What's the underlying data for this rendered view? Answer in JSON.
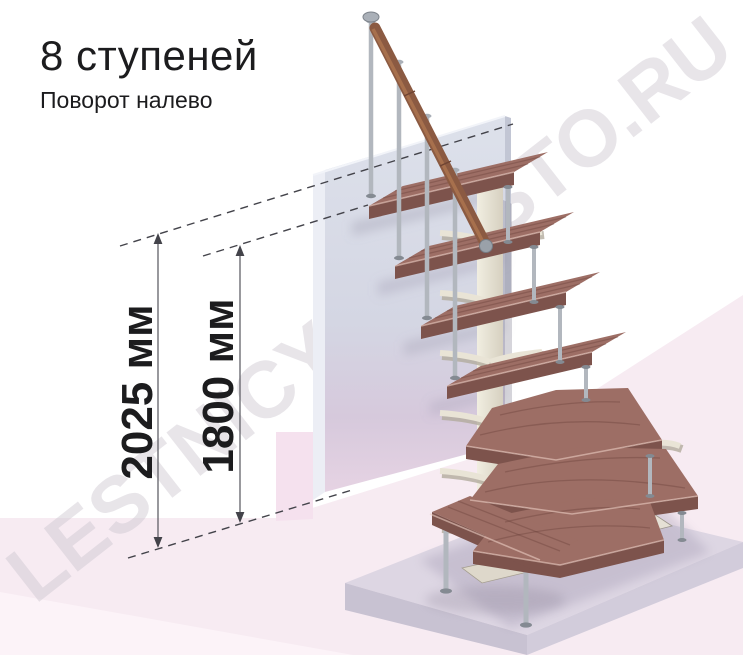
{
  "header": {
    "title": "8 ступеней",
    "subtitle": "Поворот налево"
  },
  "dimensions": {
    "total_height": {
      "label": "2025 мм"
    },
    "top_step_height": {
      "label": "1800 мм"
    }
  },
  "watermark": {
    "text": "LESTNICY-PROSTO.RU"
  },
  "colors": {
    "wood_top": "#9d6e65",
    "wood_front": "#7d534c",
    "wood_side": "#8a5c54",
    "handrail": "#8b5a42",
    "metal": "#b2b7be",
    "column": "#eae5d7",
    "wall": "#d7dae6",
    "floor": "#f7ebf2",
    "platform_top": "#ddd6e3",
    "watermark": "#c9c3cd",
    "dimension_line": "#55555c",
    "dash_line": "#43434a",
    "text": "#1c1c1e"
  }
}
